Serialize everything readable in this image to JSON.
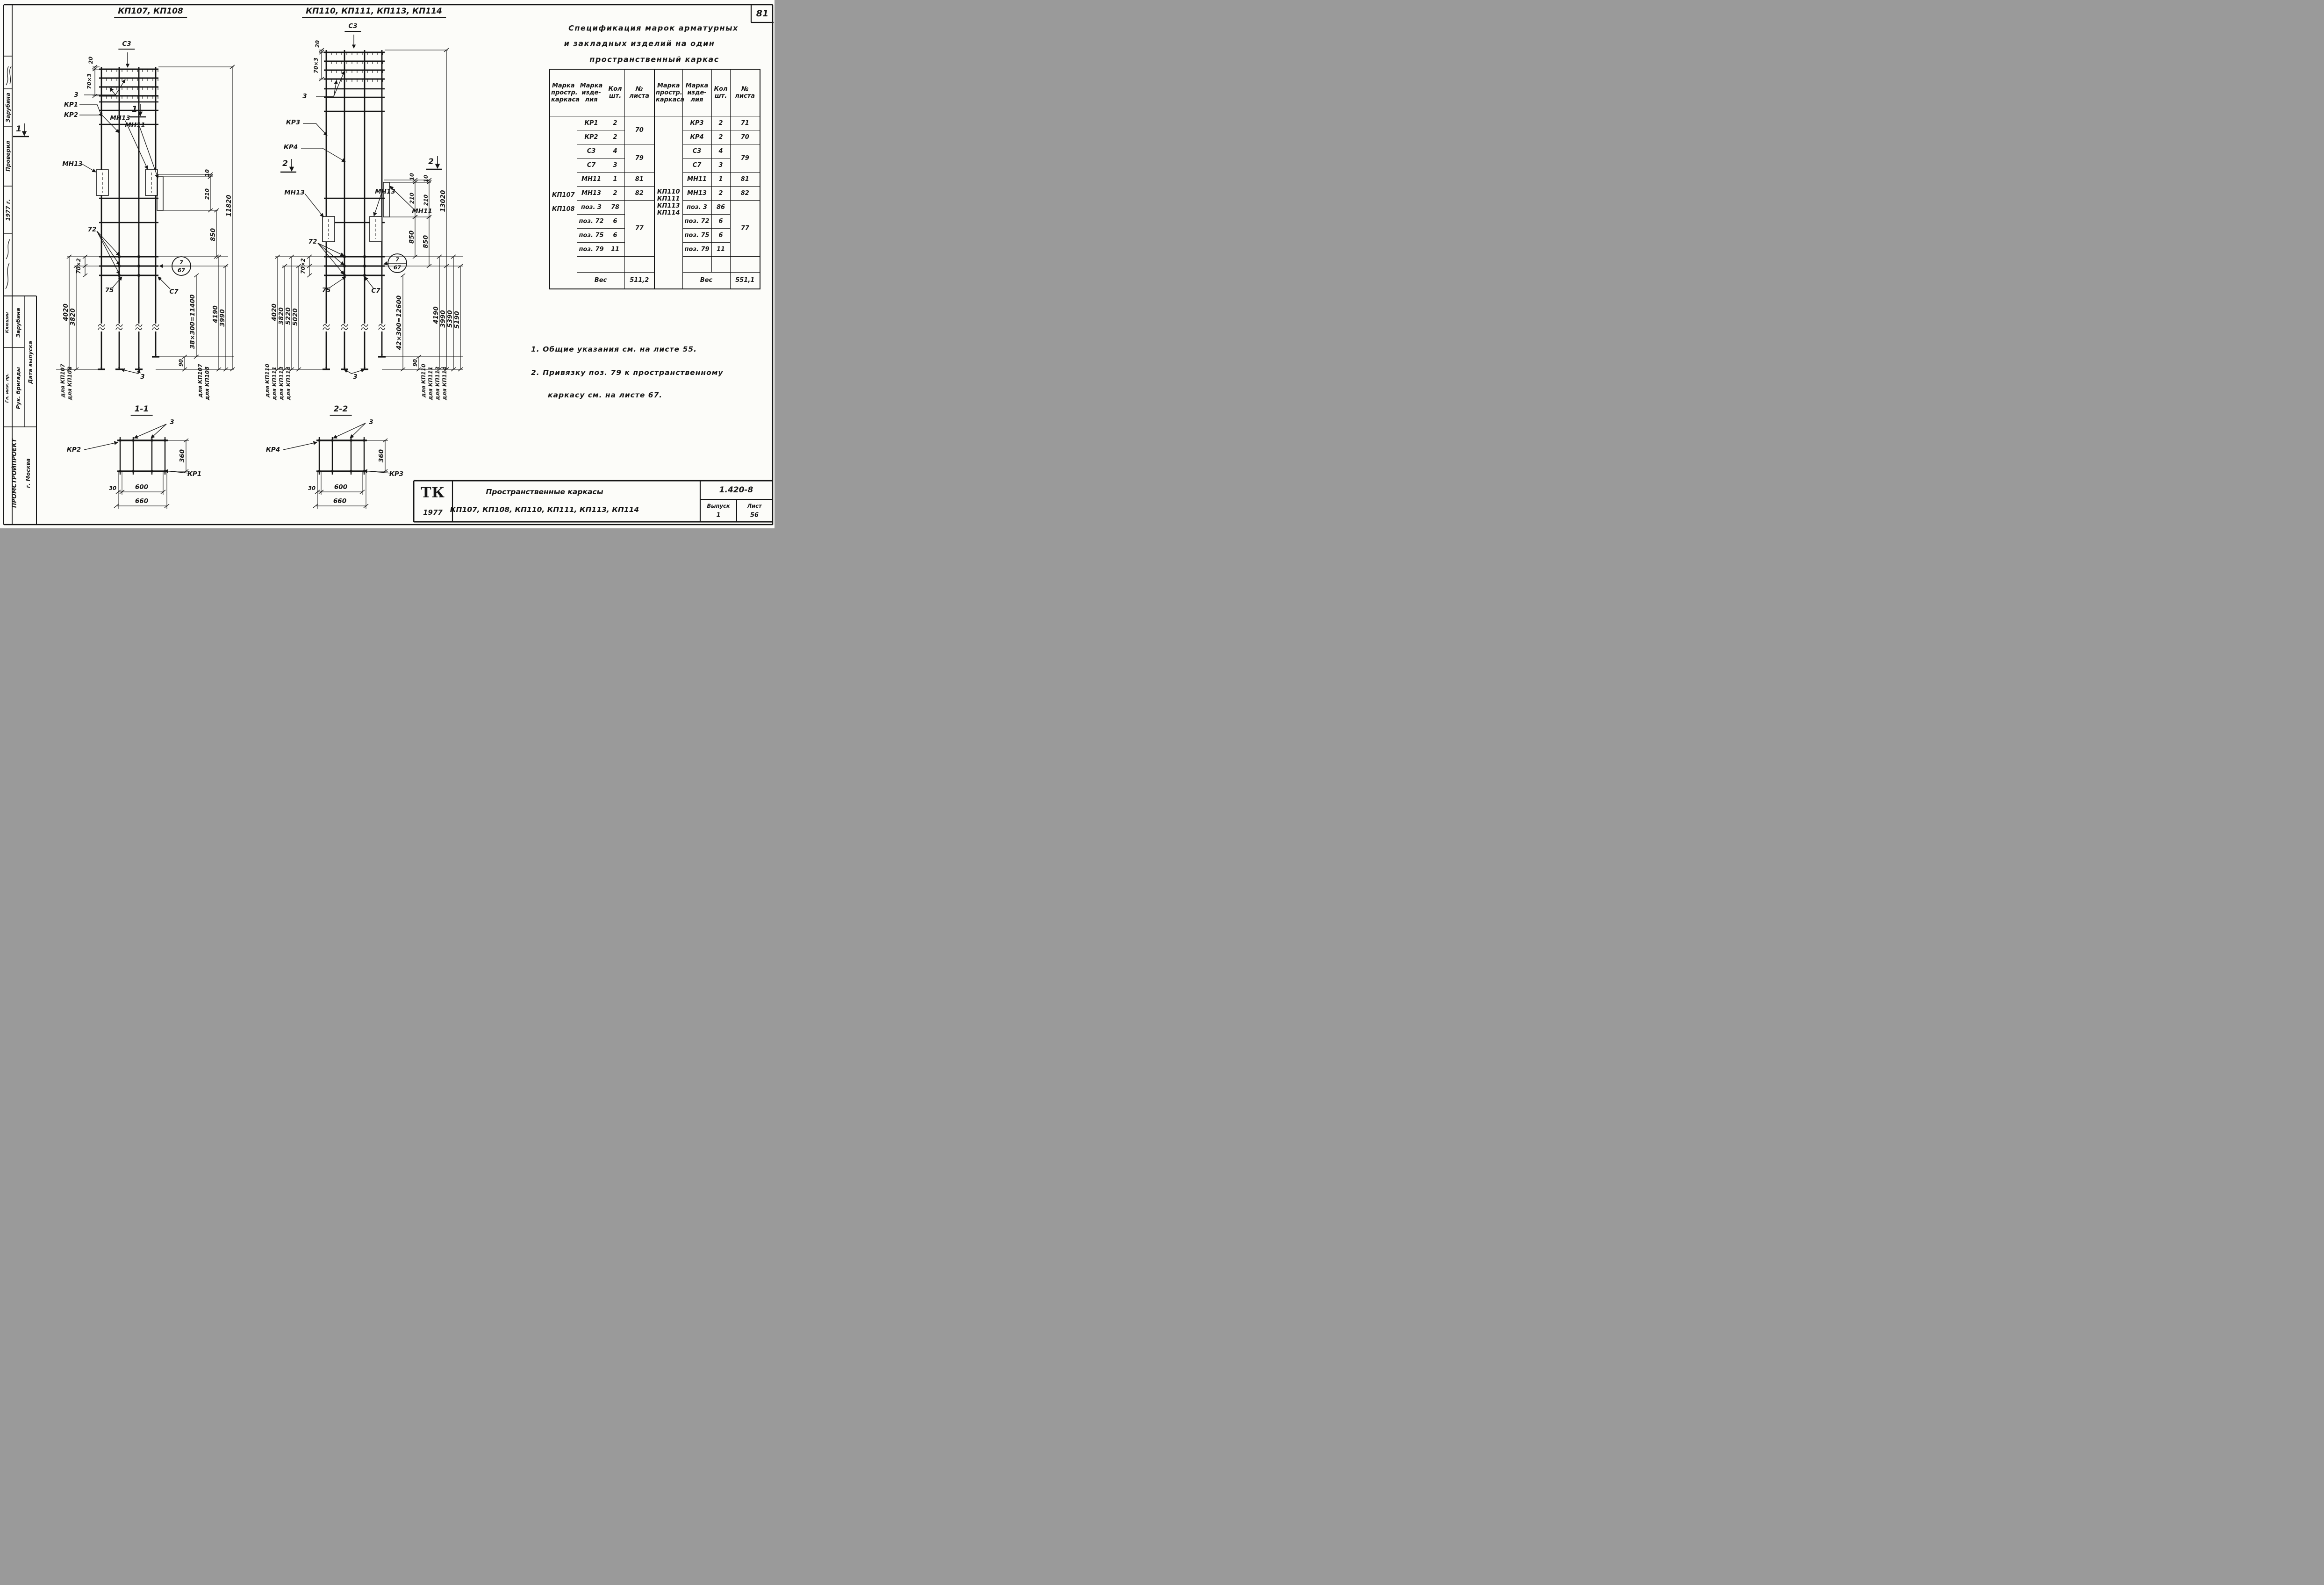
{
  "page": {
    "num": "81"
  },
  "stamp": {
    "checked_label": "Проверил",
    "checked_name": "Зарубина",
    "year": "1977 г.",
    "chief_label": "Гл. инж. пр.",
    "chief_name": "Клюшин",
    "brigade_label": "Рук. бригады",
    "brigade_name": "Зарубина",
    "date_label": "Дата выпуска",
    "org": "ПРОМСТРОЙПРОЕКТ",
    "city": "г. Москва"
  },
  "d": {
    "l": {
      "t": "КП107, КП108",
      "c3": "С3",
      "d20": "20",
      "d70x3": "70×3",
      "n3": "3",
      "kr1": "КР1",
      "kr2": "КР2",
      "mn13": "МН13",
      "mn11": "МН11",
      "d10": "10",
      "d210": "210",
      "d850": "850",
      "d11820": "11820",
      "n72": "72",
      "d70x2": "70×2",
      "n75": "75",
      "c7": "С7",
      "det_top": "7",
      "det_bot": "67",
      "d4020": "4020",
      "d3820": "3820",
      "d38x300": "38×300=11400",
      "d4190": "4190",
      "d3990": "3990",
      "d90": "90",
      "f1": "для КП107",
      "f2": "для КП108",
      "sec": "1"
    },
    "r": {
      "t": "КП110, КП111, КП113,  КП114",
      "c3": "С3",
      "d20": "20",
      "d70x3": "70×3",
      "n3": "3",
      "kr3": "КР3",
      "kr4": "КР4",
      "mn13": "МН13",
      "mn11": "МН11",
      "d10": "10",
      "d210": "210",
      "d850": "850",
      "d13020": "13020",
      "n72": "72",
      "d70x2": "70×2",
      "n75": "75",
      "c7": "С7",
      "det_top": "7",
      "det_bot": "67",
      "d42x300": "42×300=12600",
      "d4020": "4020",
      "d3820": "3820",
      "d5220": "5220",
      "d5020": "5020",
      "d4190": "4190",
      "d3990": "3990",
      "d5390": "5390",
      "d5190": "5190",
      "d90": "90",
      "f1": "для КП110",
      "f2": "для КП111",
      "f3": "для КП113",
      "f4": "для КП114",
      "sec": "2"
    }
  },
  "sec": {
    "s1": {
      "t": "1-1",
      "n3": "3",
      "outer": "КР2",
      "corner": "КР1",
      "d360": "360",
      "d30": "30",
      "d600": "600",
      "d660": "660"
    },
    "s2": {
      "t": "2-2",
      "n3": "3",
      "outer": "КР4",
      "corner": "КР3",
      "d360": "360",
      "d30": "30",
      "d600": "600",
      "d660": "660"
    }
  },
  "spec": {
    "title1": "Спецификация  марок  арматурных",
    "title2": "и  закладных  изделий  на  один",
    "title3": "пространственный  каркас",
    "cols": {
      "c1": "Марка\nпростр.\nкаркаса",
      "c2": "Марка\nизде-\nлия",
      "c3": "Кол\nшт.",
      "c4": "№\nлиста"
    },
    "t1": {
      "k": "КП107\n\nКП108",
      "r0m": "КР1",
      "r0q": "2",
      "r0s": "70",
      "r1m": "КР2",
      "r1q": "2",
      "r2m": "С3",
      "r2q": "4",
      "r2s": "79",
      "r3m": "С7",
      "r3q": "3",
      "r4m": "МН11",
      "r4q": "1",
      "r4s": "81",
      "r5m": "МН13",
      "r5q": "2",
      "r5s": "82",
      "r6m": "поз. 3",
      "r6q": "78",
      "r6s": "77",
      "r7m": "поз. 72",
      "r7q": "6",
      "r8m": "поз. 75",
      "r8q": "6",
      "r9m": "поз. 79",
      "r9q": "11",
      "wl": "Вес",
      "wv": "511,2"
    },
    "t2": {
      "k": "КП110\nКП111\nКП113\nКП114",
      "r0m": "КР3",
      "r0q": "2",
      "r0s": "71",
      "r1m": "КР4",
      "r1q": "2",
      "r1s": "70",
      "r2m": "С3",
      "r2q": "4",
      "r2s": "79",
      "r3m": "С7",
      "r3q": "3",
      "r4m": "МН11",
      "r4q": "1",
      "r4s": "81",
      "r5m": "МН13",
      "r5q": "2",
      "r5s": "82",
      "r6m": "поз. 3",
      "r6q": "86",
      "r6s": "77",
      "r7m": "поз. 72",
      "r7q": "6",
      "r8m": "поз. 75",
      "r8q": "6",
      "r9m": "поз. 79",
      "r9q": "11",
      "wl": "Вес",
      "wv": "551,1"
    }
  },
  "notes": {
    "l1": "1.  Общие  указания  см.  на  листе  55.",
    "l2": "2.  Привязку  поз. 79  к  пространственному",
    "l3": "каркасу  см.  на  листе  67."
  },
  "tb": {
    "logo": "ТК",
    "year": "1977",
    "line1": "Пространственные   каркасы",
    "line2": "КП107, КП108, КП110,  КП111,  КП113,  КП114",
    "code": "1.420-8",
    "issue_label": "Выпуск",
    "issue_no": "1",
    "sheet_label": "Лист",
    "sheet_no": "56"
  }
}
